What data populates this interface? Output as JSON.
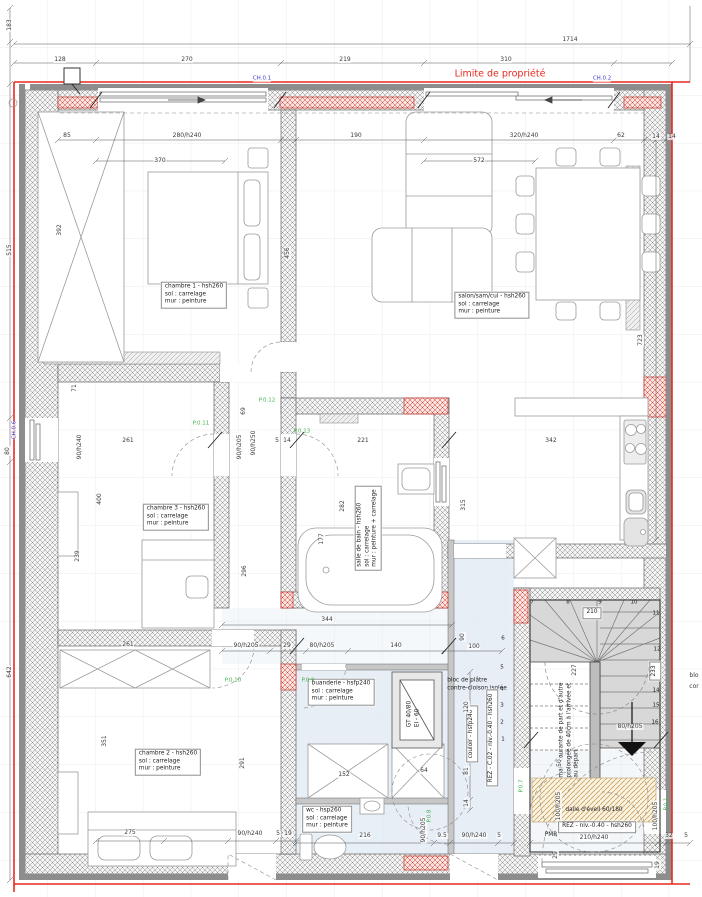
{
  "annotations": {
    "property_line": "Limite de propriété"
  },
  "colors": {
    "property_line": "#e8291f",
    "door_tag": "#3fae49",
    "window_tag": "#3a3ac8",
    "dimension_text": "#3a3a3a",
    "zone_blue": "#dfe9f4",
    "stair_gray": "#d8d8d8",
    "red_wall_highlight": "#d23b2f",
    "tan_hatch": "#c9a05a"
  },
  "room_labels": [
    {
      "id": "chambre1",
      "lines": [
        "chambre 1 - hsh260",
        "sol : carrelage",
        "mur : peinture"
      ],
      "x": 194,
      "y": 295,
      "r": 0,
      "boxed": true
    },
    {
      "id": "salon",
      "lines": [
        "salon/sam/cui - hsh260",
        "sol : carrelage",
        "mur : peinture"
      ],
      "x": 492,
      "y": 305,
      "r": 0,
      "boxed": true
    },
    {
      "id": "chambre3",
      "lines": [
        "chambre 3 - hsh260",
        "sol : carrelage",
        "mur : peinture"
      ],
      "x": 176,
      "y": 517,
      "r": 0,
      "boxed": true
    },
    {
      "id": "salle-de-bain",
      "lines": [
        "salle de bain - hsh260",
        "sol : carrelage",
        "mur : peinture + carrelage"
      ],
      "x": 368,
      "y": 528,
      "r": -90,
      "boxed": true
    },
    {
      "id": "chambre2",
      "lines": [
        "chambre 2 - hsh260",
        "sol : carrelage",
        "mur : peinture"
      ],
      "x": 168,
      "y": 762,
      "r": 0,
      "boxed": true
    },
    {
      "id": "buanderie",
      "lines": [
        "buanderie - hsfp240",
        "sol : carrelage",
        "mur : peinture"
      ],
      "x": 341,
      "y": 692,
      "r": 0,
      "boxed": true
    },
    {
      "id": "wc",
      "lines": [
        "wc - hsp260",
        "sol : carrelage",
        "mur : peinture"
      ],
      "x": 327,
      "y": 819,
      "r": 0,
      "boxed": true
    },
    {
      "id": "bloc-platre",
      "lines": [
        "bloc de plâtre",
        "contre-cloison isolée"
      ],
      "x": 477,
      "y": 685,
      "r": 0,
      "boxed": false
    },
    {
      "id": "couloir",
      "lines": [
        "couloir - hsfp240"
      ],
      "x": 472,
      "y": 734,
      "r": -90,
      "boxed": true
    },
    {
      "id": "rez-c02",
      "lines": [
        "REZ - C.02 - niv.-0.40 - hsh260"
      ],
      "x": 492,
      "y": 738,
      "r": -90,
      "boxed": true
    },
    {
      "id": "gt-duct",
      "lines": [
        "GT 40/80",
        "EI - 60"
      ],
      "x": 414,
      "y": 714,
      "r": -90,
      "boxed": false
    },
    {
      "id": "main-courante",
      "lines": [
        "main courante de part et d'autre",
        "prolongée de 40cm à l'arrivée et",
        "au départ"
      ],
      "x": 570,
      "y": 730,
      "r": -90,
      "boxed": false
    },
    {
      "id": "dalle-eveil",
      "lines": [
        "dalle d'éveil 60/180"
      ],
      "x": 594,
      "y": 811,
      "r": 0,
      "boxed": false
    },
    {
      "id": "rez-niv",
      "lines": [
        "REZ - niv.-0.40 - hsh260"
      ],
      "x": 597,
      "y": 827,
      "r": 0,
      "boxed": true
    },
    {
      "id": "pmr",
      "lines": [
        "PMR"
      ],
      "x": 551,
      "y": 836,
      "r": 0,
      "boxed": false
    },
    {
      "id": "stair-210",
      "lines": [
        "210"
      ],
      "x": 592,
      "y": 613,
      "r": 0,
      "boxed": true
    },
    {
      "id": "stair-233",
      "lines": [
        "233"
      ],
      "x": 655,
      "y": 671,
      "r": -90,
      "boxed": true
    }
  ],
  "dimensions": [
    {
      "t": "1714",
      "x": 570,
      "y": 40
    },
    {
      "t": "128",
      "x": 60,
      "y": 60
    },
    {
      "t": "270",
      "x": 187,
      "y": 60
    },
    {
      "t": "219",
      "x": 345,
      "y": 60
    },
    {
      "t": "310",
      "x": 506,
      "y": 60
    },
    {
      "t": "183",
      "x": 10,
      "y": 25,
      "r": -90
    },
    {
      "t": "515",
      "x": 10,
      "y": 250,
      "r": -90
    },
    {
      "t": "80",
      "x": 8,
      "y": 451,
      "r": -90
    },
    {
      "t": "642",
      "x": 10,
      "y": 672,
      "r": -90
    },
    {
      "t": "85",
      "x": 67,
      "y": 136
    },
    {
      "t": "280/h240",
      "x": 187,
      "y": 136
    },
    {
      "t": "190",
      "x": 356,
      "y": 136
    },
    {
      "t": "320/h240",
      "x": 524,
      "y": 136
    },
    {
      "t": "62",
      "x": 621,
      "y": 136
    },
    {
      "t": "14",
      "x": 656,
      "y": 137
    },
    {
      "t": "14",
      "x": 672,
      "y": 137
    },
    {
      "t": "370",
      "x": 160,
      "y": 161
    },
    {
      "t": "572",
      "x": 479,
      "y": 161
    },
    {
      "t": "392",
      "x": 60,
      "y": 230,
      "r": -90
    },
    {
      "t": "456",
      "x": 288,
      "y": 253,
      "r": -90
    },
    {
      "t": "723",
      "x": 641,
      "y": 340,
      "r": -90
    },
    {
      "t": "71",
      "x": 75,
      "y": 388,
      "r": -90
    },
    {
      "t": "69",
      "x": 244,
      "y": 411,
      "r": -90
    },
    {
      "t": "90/h240",
      "x": 80,
      "y": 447,
      "r": -90
    },
    {
      "t": "261",
      "x": 128,
      "y": 441
    },
    {
      "t": "90/h205",
      "x": 240,
      "y": 447,
      "r": -90
    },
    {
      "t": "90/h250",
      "x": 254,
      "y": 443,
      "r": -90
    },
    {
      "t": "5",
      "x": 277,
      "y": 441
    },
    {
      "t": "14",
      "x": 287,
      "y": 441
    },
    {
      "t": "221",
      "x": 363,
      "y": 441
    },
    {
      "t": "342",
      "x": 551,
      "y": 441
    },
    {
      "t": "400",
      "x": 100,
      "y": 499,
      "r": -90
    },
    {
      "t": "239",
      "x": 78,
      "y": 556,
      "r": -90
    },
    {
      "t": "296",
      "x": 245,
      "y": 571,
      "r": -90
    },
    {
      "t": "282",
      "x": 343,
      "y": 506,
      "r": -90
    },
    {
      "t": "177",
      "x": 322,
      "y": 539,
      "r": -90
    },
    {
      "t": "315",
      "x": 464,
      "y": 505,
      "r": -90
    },
    {
      "t": "344",
      "x": 327,
      "y": 620
    },
    {
      "t": "90",
      "x": 463,
      "y": 637,
      "r": -90
    },
    {
      "t": "100",
      "x": 474,
      "y": 647
    },
    {
      "t": "90/h205",
      "x": 246,
      "y": 646
    },
    {
      "t": "29",
      "x": 287,
      "y": 646
    },
    {
      "t": "80/h205",
      "x": 322,
      "y": 646
    },
    {
      "t": "140",
      "x": 396,
      "y": 646
    },
    {
      "t": "120",
      "x": 467,
      "y": 707,
      "r": -90
    },
    {
      "t": "81",
      "x": 467,
      "y": 771,
      "r": -90
    },
    {
      "t": "14",
      "x": 467,
      "y": 803,
      "r": -90
    },
    {
      "t": "64",
      "x": 424,
      "y": 771
    },
    {
      "t": "152",
      "x": 344,
      "y": 775
    },
    {
      "t": "351",
      "x": 105,
      "y": 741,
      "r": -90
    },
    {
      "t": "291",
      "x": 243,
      "y": 763,
      "r": -90
    },
    {
      "t": "261",
      "x": 128,
      "y": 645
    },
    {
      "t": "216",
      "x": 365,
      "y": 836
    },
    {
      "t": "90/h205",
      "x": 424,
      "y": 830,
      "r": -90
    },
    {
      "t": "9.5",
      "x": 442,
      "y": 836
    },
    {
      "t": "90/h240",
      "x": 474,
      "y": 836
    },
    {
      "t": "5",
      "x": 499,
      "y": 836
    },
    {
      "t": "275",
      "x": 130,
      "y": 833
    },
    {
      "t": "90/h240",
      "x": 250,
      "y": 834
    },
    {
      "t": "5",
      "x": 278,
      "y": 834
    },
    {
      "t": "19",
      "x": 288,
      "y": 834
    },
    {
      "t": "50",
      "x": 560,
      "y": 763,
      "r": -90
    },
    {
      "t": "100/h205",
      "x": 559,
      "y": 806,
      "r": -90
    },
    {
      "t": "100/h205",
      "x": 656,
      "y": 816,
      "r": -90
    },
    {
      "t": "32",
      "x": 669,
      "y": 836
    },
    {
      "t": "5",
      "x": 686,
      "y": 836
    },
    {
      "t": "29",
      "x": 556,
      "y": 855,
      "r": -90
    },
    {
      "t": "19",
      "x": 658,
      "y": 865,
      "r": -90
    },
    {
      "t": "210/h240",
      "x": 594,
      "y": 838
    },
    {
      "t": "80/h205",
      "x": 630,
      "y": 727
    },
    {
      "t": "227",
      "x": 575,
      "y": 670,
      "r": -90
    },
    {
      "t": "blo",
      "x": 694,
      "y": 676
    },
    {
      "t": "cor",
      "x": 694,
      "y": 687
    }
  ],
  "door_tags": [
    {
      "t": "P.0.11",
      "x": 201,
      "y": 424
    },
    {
      "t": "P.0.12",
      "x": 267,
      "y": 401
    },
    {
      "t": "P.0.13",
      "x": 302,
      "y": 432
    },
    {
      "t": "P.0.10",
      "x": 233,
      "y": 681
    },
    {
      "t": "P.0.9",
      "x": 308,
      "y": 681
    },
    {
      "t": "P.0.8",
      "x": 430,
      "y": 816,
      "r": -90
    },
    {
      "t": "P.0.7",
      "x": 522,
      "y": 786,
      "r": -90
    },
    {
      "t": "P.0.1",
      "x": 667,
      "y": 804,
      "r": -90
    }
  ],
  "window_tags": [
    {
      "t": "CH.0.1",
      "x": 262,
      "y": 79
    },
    {
      "t": "CH.0.2",
      "x": 602,
      "y": 79
    },
    {
      "t": "CH.0.6",
      "x": 15,
      "y": 430,
      "r": -90
    }
  ],
  "stair_steps": [
    {
      "t": "1",
      "x": 503,
      "y": 740
    },
    {
      "t": "2",
      "x": 502,
      "y": 723
    },
    {
      "t": "3",
      "x": 502,
      "y": 706
    },
    {
      "t": "4",
      "x": 502,
      "y": 690
    },
    {
      "t": "5",
      "x": 502,
      "y": 668
    },
    {
      "t": "6",
      "x": 503,
      "y": 639
    },
    {
      "t": "7",
      "x": 532,
      "y": 603
    },
    {
      "t": "8",
      "x": 568,
      "y": 603
    },
    {
      "t": "9",
      "x": 600,
      "y": 603
    },
    {
      "t": "10",
      "x": 634,
      "y": 603
    },
    {
      "t": "11",
      "x": 656,
      "y": 614
    },
    {
      "t": "12",
      "x": 657,
      "y": 650
    },
    {
      "t": "14",
      "x": 656,
      "y": 691
    },
    {
      "t": "15",
      "x": 656,
      "y": 706
    },
    {
      "t": "16",
      "x": 655,
      "y": 723
    }
  ]
}
